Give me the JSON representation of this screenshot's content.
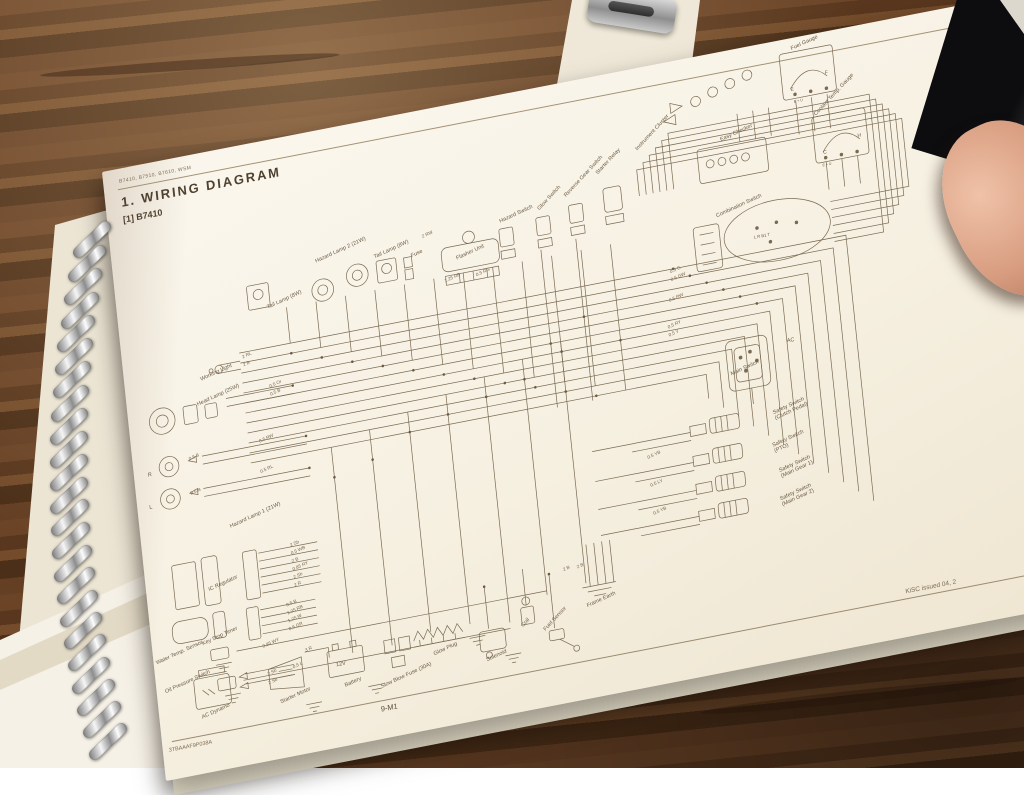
{
  "page": {
    "header_small": "B7410, B7510, B7610, WSM",
    "title": "1.  WIRING  DIAGRAM",
    "subtitle": "[1]  B7410",
    "footer_code": "3TBAAAF9P038A",
    "footer_page": "9-M1",
    "footer_right": "KiSC issued 04, 2"
  },
  "diagram": {
    "labels": [
      "Tail Lamp (8W)",
      "Hazard Lamp 2 (21W)",
      "Tail Lamp (8W)",
      "Fuse",
      "Flasher Unit",
      "Hazard Switch",
      "Glow Switch",
      "Reverse Gear Switch",
      "Starter Relay",
      "Instrument Cluster",
      "Easy Checker",
      "Fuel Gauge",
      "Coolant Temp. Gauge",
      "Combination Switch",
      "Main Switch",
      "AC",
      "Working Light",
      "Head Lamp (25W)",
      "R",
      "L",
      "Hazard Lamp 1 (21W)",
      "IC Regulator",
      "Key Stop Timer",
      "Water Temp. Sensor",
      "Oil Pressure Switch",
      "AC Dynamo",
      "Starter Motor",
      "Battery",
      "Slow Blow Fuse (30A)",
      "Glow Plug",
      "Solenoid",
      "Coil",
      "Fuel Sensor",
      "Frame Earth",
      "Safety Switch\n(Clutch Pedal)",
      "Safety Switch\n(PTO)",
      "Safety Switch\n(Main Gear 1)",
      "Safety Switch\n(Main Gear 2)"
    ],
    "wire_codes": [
      "2 RL",
      "2 B",
      "0.5 Or",
      "0.5 B",
      "0.5 RW",
      "0.5 B",
      "0.5 RL",
      "0.5 B",
      "2 Sb",
      "0.5 WB",
      "2 B",
      "0.85 RY",
      "2 Sb",
      "2 R",
      "0.5 B",
      "1.25 RB",
      "1.25 W",
      "0.5 GR",
      "0.85 WY",
      "0.5 L",
      "2 Sb",
      "2 Sb",
      "3 R",
      "2 RW",
      "1.25 RB",
      "0.5 RG",
      "0.5 G",
      "0.5 GW",
      "0.5 RW",
      "0.5 RY",
      "0.5 Y",
      "0.5 YB",
      "0.5 LY",
      "0.5 YB",
      "2 B",
      "2 B"
    ],
    "battery_label": "12V",
    "fuel_gauge": {
      "low": "E",
      "high": "F",
      "terminals": "E + U"
    },
    "coolant_gauge": {
      "low": "C",
      "high": "H",
      "terminals": "E + U"
    },
    "combination_terminals": "L  R  B1  T"
  }
}
